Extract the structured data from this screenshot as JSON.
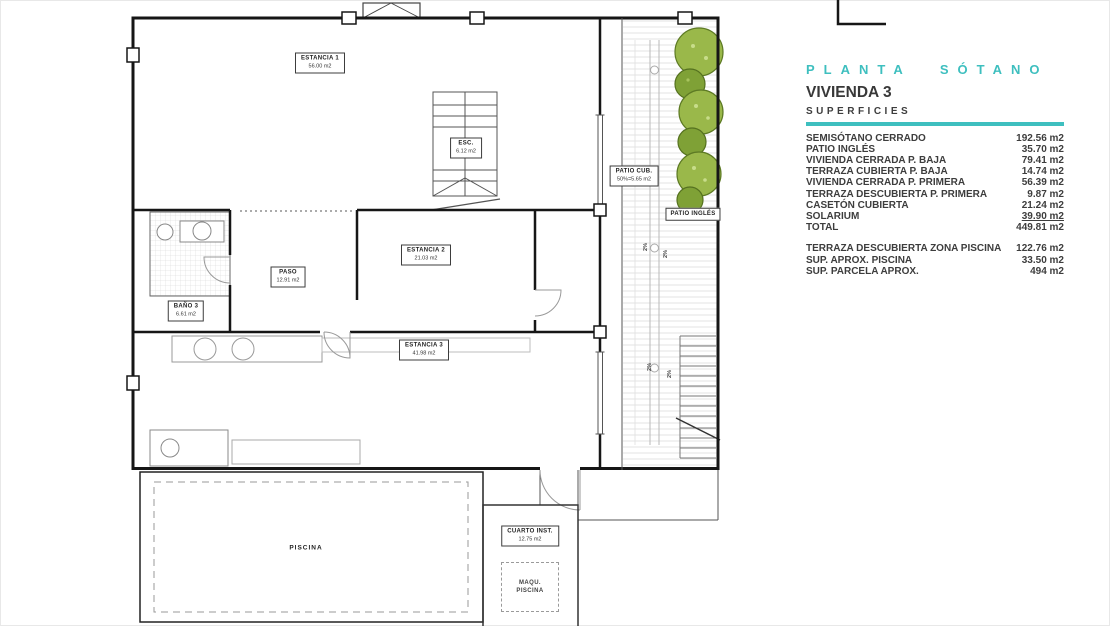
{
  "panel": {
    "plan_title": "PLANTA SÓTANO",
    "unit_title": "VIVIENDA 3",
    "section_title": "SUPERFICIES",
    "accent_color": "#3ebfbf",
    "rows": [
      {
        "label": "SEMISÓTANO CERRADO",
        "value": "192.56 m2"
      },
      {
        "label": "PATIO INGLÉS",
        "value": "35.70 m2"
      },
      {
        "label": "VIVIENDA CERRADA P. BAJA",
        "value": "79.41 m2"
      },
      {
        "label": "TERRAZA CUBIERTA P. BAJA",
        "value": "14.74 m2"
      },
      {
        "label": "VIVIENDA CERRADA P. PRIMERA",
        "value": "56.39 m2"
      },
      {
        "label": "TERRAZA DESCUBIERTA P. PRIMERA",
        "value": "9.87 m2"
      },
      {
        "label": "CASETÓN CUBIERTA",
        "value": "21.24 m2"
      },
      {
        "label": "SOLARIUM",
        "value": "39.90 m2"
      },
      {
        "label": "TOTAL",
        "value": "449.81 m2"
      }
    ],
    "rows2": [
      {
        "label": "TERRAZA DESCUBIERTA  ZONA PISCINA",
        "value": "122.76 m2"
      },
      {
        "label": "SUP.  APROX.  PISCINA",
        "value": "33.50 m2"
      },
      {
        "label": "SUP. PARCELA APROX.",
        "value": "494 m2"
      }
    ]
  },
  "plan": {
    "labels": {
      "estancia1": {
        "name": "ESTANCIA 1",
        "area": "56.00 m2"
      },
      "esc": {
        "name": "ESC.",
        "area": "6.12 m2"
      },
      "patio_cub": {
        "name": "PATIO CUB.",
        "area": "50%=5.65 m2"
      },
      "bano3": {
        "name": "BAÑO 3",
        "area": "6.61 m2"
      },
      "paso": {
        "name": "PASO",
        "area": "12.91 m2"
      },
      "estancia2": {
        "name": "ESTANCIA 2",
        "area": "21.03 m2"
      },
      "estancia3": {
        "name": "ESTANCIA 3",
        "area": "41.98 m2"
      },
      "patio_ingles": {
        "name": "PATIO INGLÉS"
      },
      "piscina": {
        "name": "PISCINA"
      },
      "cuarto_inst": {
        "name": "CUARTO INST.",
        "area": "12.75 m2"
      },
      "maqu_piscina": {
        "line1": "MAQU.",
        "line2": "PISCINA"
      },
      "slope": "2%"
    }
  }
}
